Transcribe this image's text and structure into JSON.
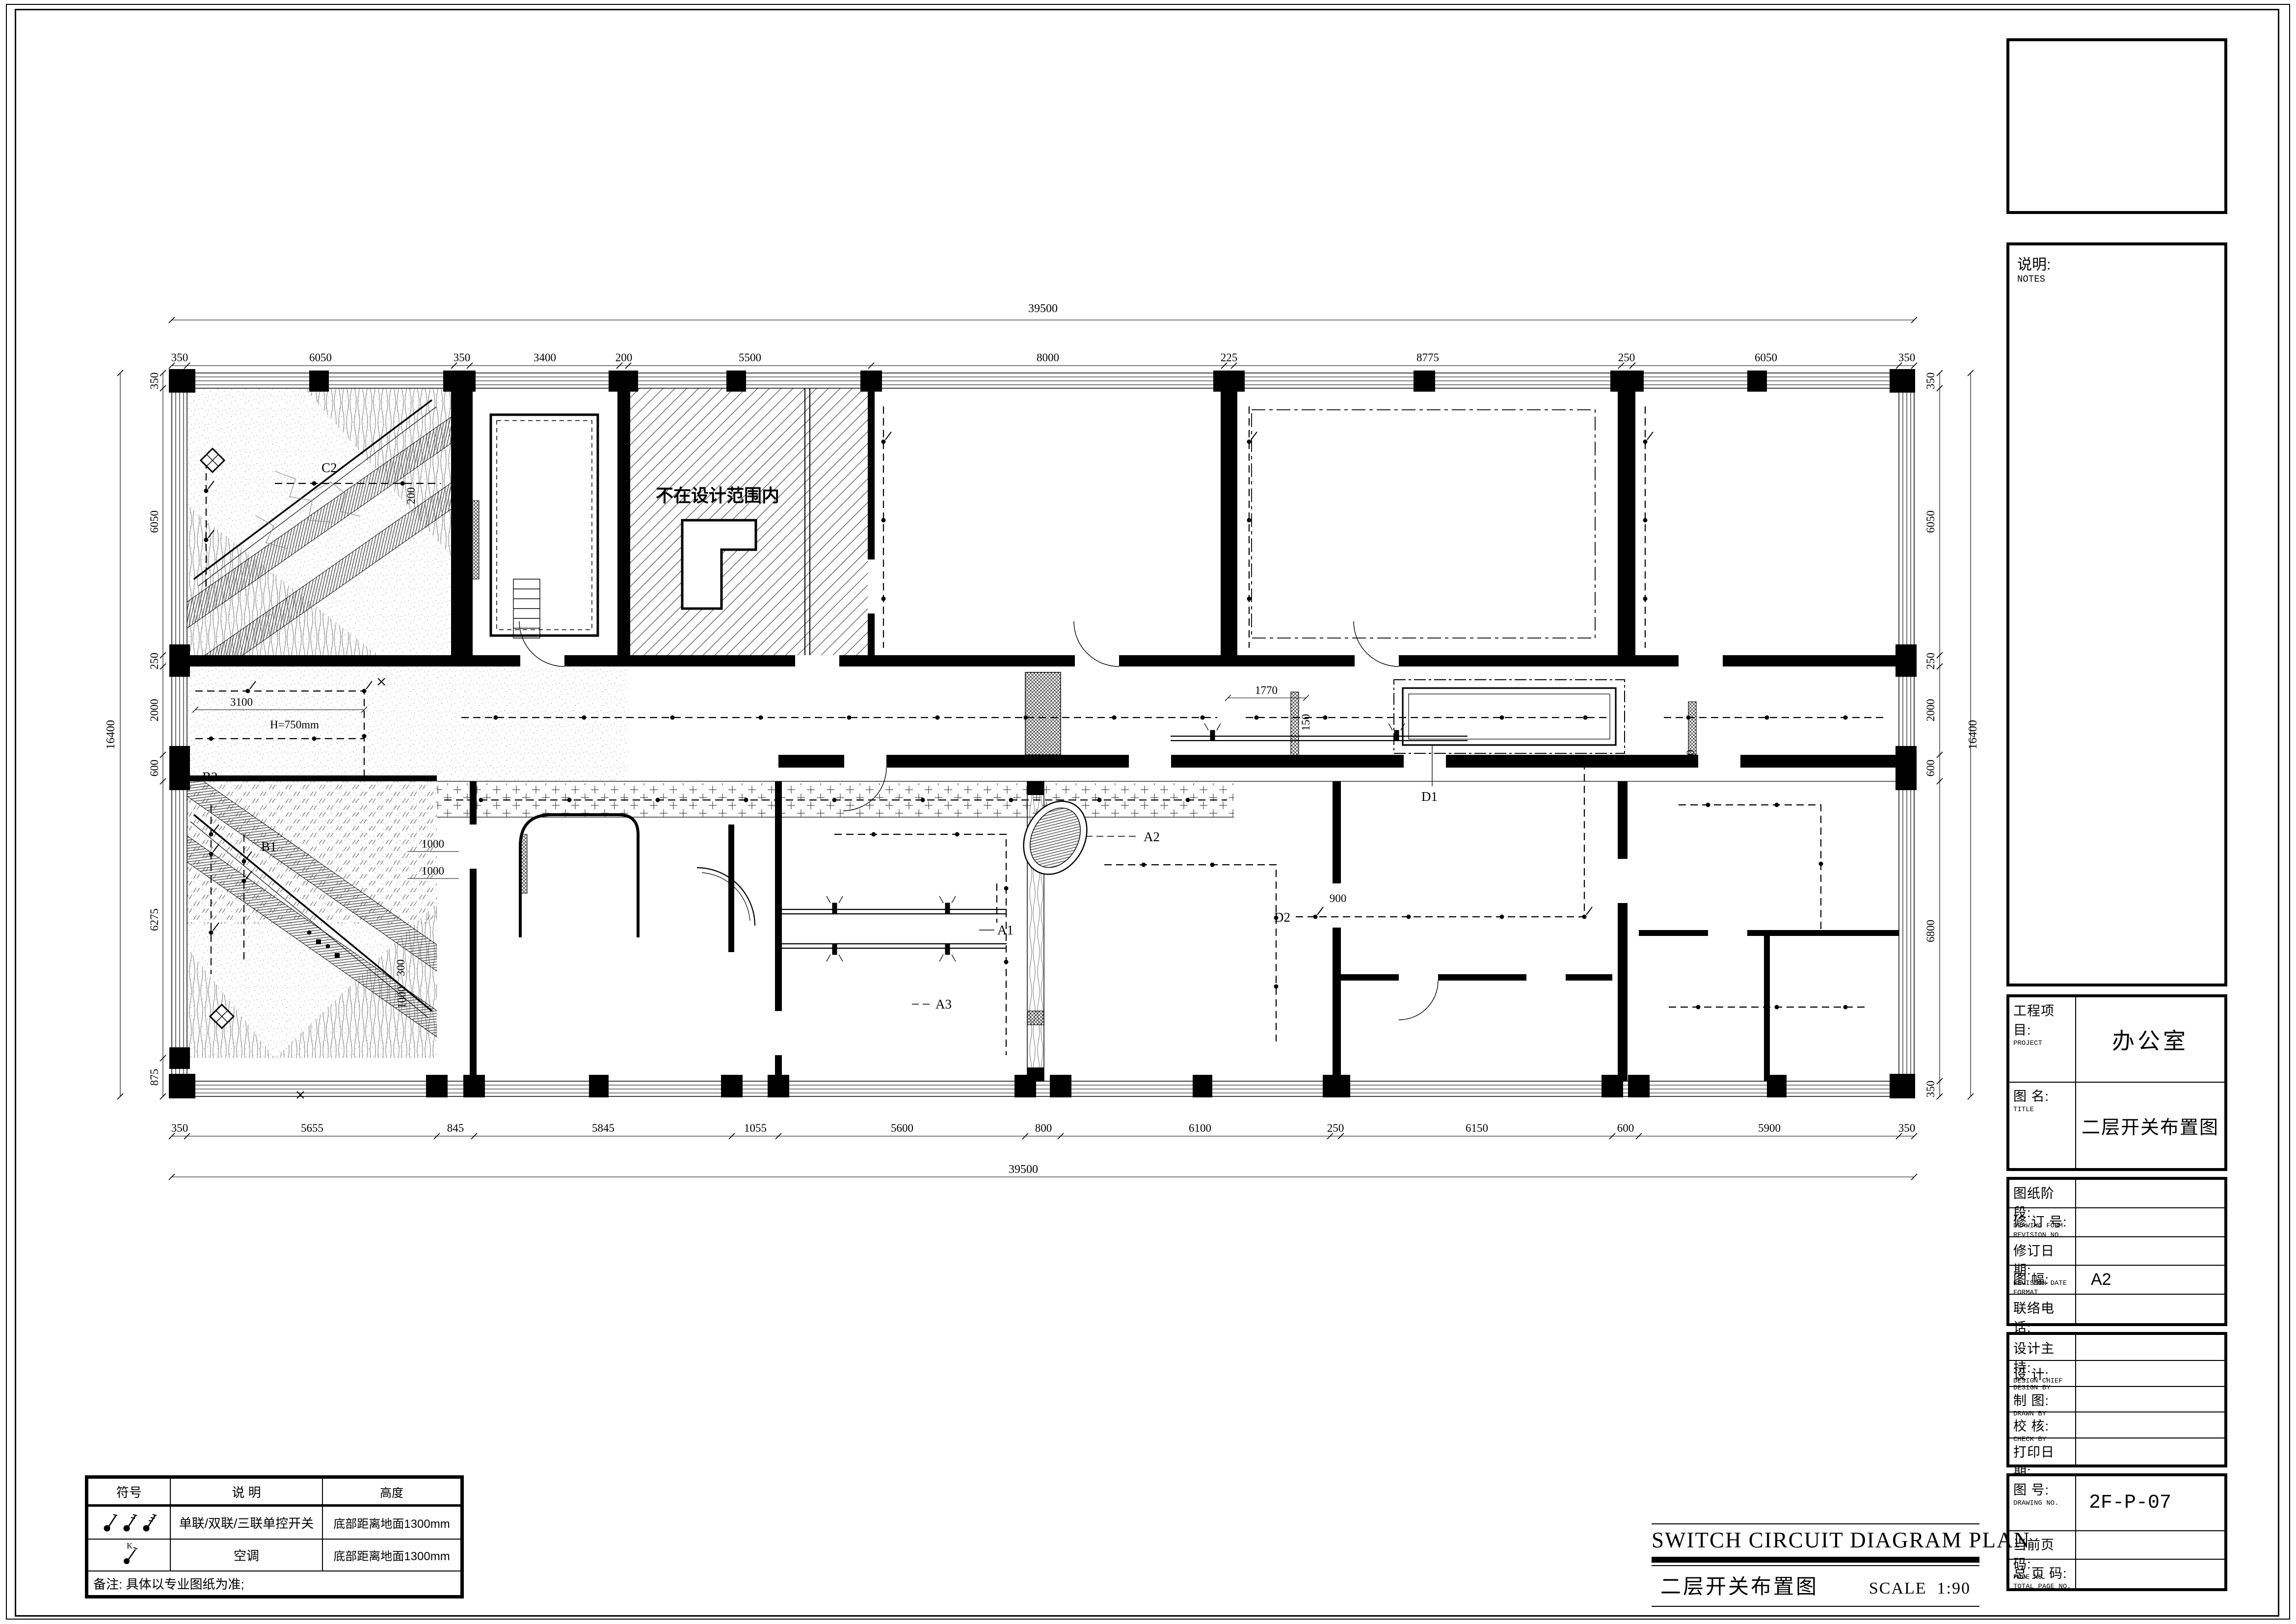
{
  "sheet": {
    "plan_title_en": "SWITCH CIRCUIT DIAGRAM PLAN",
    "plan_title_cn": "二层开关布置图",
    "scale_label": "SCALE",
    "scale_value": "1:90"
  },
  "title_block": {
    "notes": {
      "cn": "说明:",
      "en": "NOTES"
    },
    "project": {
      "cn": "工程项目:",
      "en": "PROJECT",
      "value": "办公室"
    },
    "drawing_title": {
      "cn": "图  名:",
      "en": "TITLE",
      "value": "二层开关布置图"
    },
    "drawing_form": {
      "cn": "图纸阶段:",
      "en": "DRAWING FORM",
      "value": ""
    },
    "revision_no": {
      "cn": "修 订 号:",
      "en": "REVISION NO.",
      "value": ""
    },
    "revision_date": {
      "cn": "修订日期:",
      "en": "REVISION DATE",
      "value": ""
    },
    "format": {
      "cn": "图    幅:",
      "en": "FORMAT",
      "value": "A2"
    },
    "contact": {
      "cn": "联络电话:",
      "en": "MOBEL",
      "value": ""
    },
    "design_chief": {
      "cn": "设计主持:",
      "en": "DESIGN CHIEF",
      "value": ""
    },
    "design_by": {
      "cn": "设    计:",
      "en": "DESIGN BY",
      "value": ""
    },
    "drawn_by": {
      "cn": "制    图:",
      "en": "DRAWN  BY",
      "value": ""
    },
    "check_by": {
      "cn": "校    核:",
      "en": "CHECK BY",
      "value": ""
    },
    "print_date": {
      "cn": "打印日期:",
      "en": "PRINT DATE",
      "value": ""
    },
    "drawing_no": {
      "cn": "图    号:",
      "en": "DRAWING NO.",
      "value": "2F-P-07"
    },
    "page_no": {
      "cn": "当前页码:",
      "en": "PAGE NO.",
      "value": ""
    },
    "total_page_no": {
      "cn": "总 页 码:",
      "en": "TOTAL PAGE NO.",
      "value": ""
    }
  },
  "legend": {
    "headers": [
      "符号",
      "说 明",
      "高度"
    ],
    "rows": [
      {
        "symbol": "single-double-triple-switch",
        "desc": "单联/双联/三联单控开关",
        "height": "底部距离地面1300mm"
      },
      {
        "symbol": "ac-switch",
        "k": "K",
        "desc": "空调",
        "height": "底部距离地面1300mm"
      }
    ],
    "note": "备注: 具体以专业图纸为准;"
  },
  "dimensions": {
    "top": {
      "overall": "39500",
      "segments": [
        "350",
        "6050",
        "350",
        "3400",
        "200",
        "5500",
        "8000",
        "225",
        "8775",
        "250",
        "6050",
        "350"
      ]
    },
    "bottom": {
      "overall": "39500",
      "segments": [
        "350",
        "5655",
        "845",
        "5845",
        "1055",
        "5600",
        "800",
        "6100",
        "250",
        "6150",
        "600",
        "5900",
        "350"
      ]
    },
    "left": {
      "overall": "16400",
      "segments": [
        "350",
        "6050",
        "250",
        "2000",
        "600",
        "6275",
        "875"
      ]
    },
    "right": {
      "overall": "16400",
      "segments": [
        "350",
        "6050",
        "250",
        "2000",
        "600",
        "6800",
        "350"
      ]
    }
  },
  "plan_labels": {
    "out_of_scope": "不在设计范围内",
    "c2": "C2",
    "b2": "B2",
    "b1": "B1",
    "a1": "A1",
    "a2": "A2",
    "a3": "A3",
    "d1": "D1",
    "d2": "D2",
    "h750": "H=750mm",
    "dim3100": "3100",
    "dim1770": "1770",
    "dim150a": "150",
    "dim150b": "150",
    "dim200": "200",
    "dim300": "300",
    "dim1000a": "1000",
    "dim1000b": "1000",
    "dim1000c": "1000",
    "dim900": "900"
  }
}
